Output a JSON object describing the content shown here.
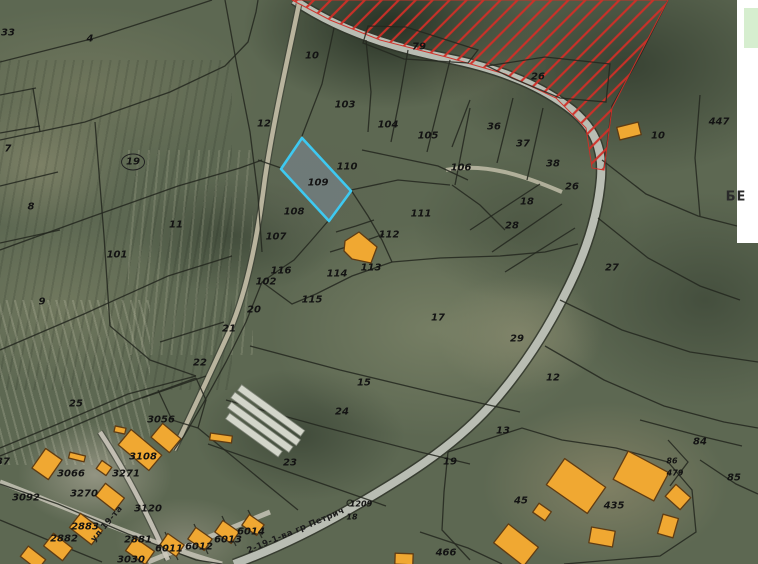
{
  "map": {
    "highlighted_parcel": "109",
    "parcel_labels": [
      {
        "text": "33",
        "x": 8,
        "y": 33
      },
      {
        "text": "4",
        "x": 90,
        "y": 39
      },
      {
        "text": "7",
        "x": 8,
        "y": 149
      },
      {
        "text": "19",
        "x": 133,
        "y": 162,
        "circled": true
      },
      {
        "text": "8",
        "x": 31,
        "y": 207
      },
      {
        "text": "11",
        "x": 176,
        "y": 225
      },
      {
        "text": "101",
        "x": 117,
        "y": 255
      },
      {
        "text": "9",
        "x": 42,
        "y": 302
      },
      {
        "text": "12",
        "x": 264,
        "y": 124
      },
      {
        "text": "10",
        "x": 312,
        "y": 56
      },
      {
        "text": "79",
        "x": 419,
        "y": 47
      },
      {
        "text": "26",
        "x": 538,
        "y": 77
      },
      {
        "text": "103",
        "x": 345,
        "y": 105
      },
      {
        "text": "104",
        "x": 388,
        "y": 125
      },
      {
        "text": "105",
        "x": 428,
        "y": 136
      },
      {
        "text": "36",
        "x": 494,
        "y": 127
      },
      {
        "text": "37",
        "x": 523,
        "y": 144
      },
      {
        "text": "38",
        "x": 553,
        "y": 164
      },
      {
        "text": "106",
        "x": 461,
        "y": 168
      },
      {
        "text": "110",
        "x": 347,
        "y": 167
      },
      {
        "text": "109",
        "x": 318,
        "y": 183
      },
      {
        "text": "26",
        "x": 572,
        "y": 187
      },
      {
        "text": "18",
        "x": 527,
        "y": 202
      },
      {
        "text": "108",
        "x": 294,
        "y": 212
      },
      {
        "text": "111",
        "x": 421,
        "y": 214
      },
      {
        "text": "28",
        "x": 512,
        "y": 226
      },
      {
        "text": "107",
        "x": 276,
        "y": 237
      },
      {
        "text": "112",
        "x": 389,
        "y": 235
      },
      {
        "text": "113",
        "x": 371,
        "y": 268
      },
      {
        "text": "114",
        "x": 337,
        "y": 274
      },
      {
        "text": "116",
        "x": 281,
        "y": 271
      },
      {
        "text": "102",
        "x": 266,
        "y": 282
      },
      {
        "text": "10",
        "x": 658,
        "y": 136
      },
      {
        "text": "447",
        "x": 719,
        "y": 122
      },
      {
        "text": "27",
        "x": 612,
        "y": 268
      },
      {
        "text": "115",
        "x": 312,
        "y": 300
      },
      {
        "text": "20",
        "x": 254,
        "y": 310
      },
      {
        "text": "21",
        "x": 229,
        "y": 329
      },
      {
        "text": "17",
        "x": 438,
        "y": 318
      },
      {
        "text": "22",
        "x": 200,
        "y": 363
      },
      {
        "text": "29",
        "x": 517,
        "y": 339
      },
      {
        "text": "12",
        "x": 553,
        "y": 378
      },
      {
        "text": "15",
        "x": 364,
        "y": 383
      },
      {
        "text": "24",
        "x": 342,
        "y": 412
      },
      {
        "text": "25",
        "x": 76,
        "y": 404
      },
      {
        "text": "3056",
        "x": 161,
        "y": 420
      },
      {
        "text": "13",
        "x": 503,
        "y": 431
      },
      {
        "text": "84",
        "x": 700,
        "y": 442
      },
      {
        "text": "19",
        "x": 450,
        "y": 462
      },
      {
        "text": "86",
        "x": 672,
        "y": 461,
        "size": "sm"
      },
      {
        "text": "479",
        "x": 675,
        "y": 473,
        "size": "sm"
      },
      {
        "text": "85",
        "x": 734,
        "y": 478
      },
      {
        "text": "23",
        "x": 290,
        "y": 463
      },
      {
        "text": "3108",
        "x": 143,
        "y": 457
      },
      {
        "text": "3066",
        "x": 71,
        "y": 474
      },
      {
        "text": "3271",
        "x": 126,
        "y": 474
      },
      {
        "text": "3092",
        "x": 26,
        "y": 498
      },
      {
        "text": "3270",
        "x": 84,
        "y": 494
      },
      {
        "text": "3120",
        "x": 148,
        "y": 509
      },
      {
        "text": "45",
        "x": 521,
        "y": 501
      },
      {
        "text": "435",
        "x": 614,
        "y": 506
      },
      {
        "text": "1209",
        "x": 361,
        "y": 504,
        "size": "sm"
      },
      {
        "text": "18",
        "x": 352,
        "y": 517,
        "size": "sm"
      },
      {
        "text": "2883",
        "x": 85,
        "y": 527
      },
      {
        "text": "2882",
        "x": 64,
        "y": 539
      },
      {
        "text": "2881",
        "x": 138,
        "y": 540
      },
      {
        "text": "6011",
        "x": 169,
        "y": 549
      },
      {
        "text": "6012",
        "x": 199,
        "y": 547
      },
      {
        "text": "6013",
        "x": 228,
        "y": 540
      },
      {
        "text": "6014",
        "x": 251,
        "y": 532
      },
      {
        "text": "3030",
        "x": 131,
        "y": 560
      },
      {
        "text": "466",
        "x": 446,
        "y": 553
      },
      {
        "text": "37",
        "x": 3,
        "y": 462
      },
      {
        "text": "БЕ",
        "x": 736,
        "y": 197,
        "size": "lg"
      }
    ],
    "street_labels": [
      {
        "text": "2-19-1-ва гр Петрич",
        "x": 296,
        "y": 531,
        "rotation": -23
      },
      {
        "text": "ул 19-та",
        "x": 107,
        "y": 524,
        "rotation": -50
      }
    ],
    "colors": {
      "highlight_outline": "#3ec9f1",
      "restriction_hatch": "#d03028",
      "building_fill": "#f0a832",
      "building_outline": "#5f3c14",
      "offmap_panel": "#d6eecf",
      "page_background": "#ffffff"
    }
  }
}
